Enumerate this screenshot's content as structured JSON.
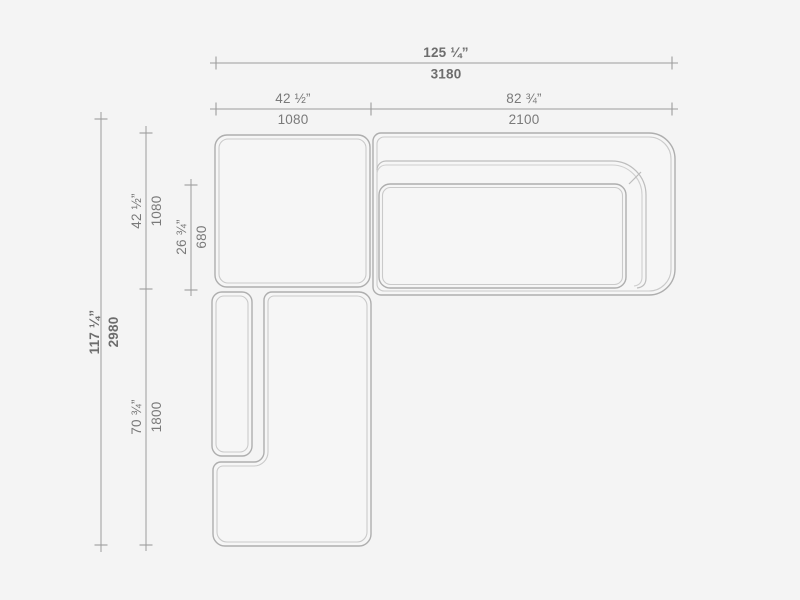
{
  "drawing": {
    "type": "sectional-sofa-top-view-dimension-drawing",
    "colors": {
      "background": "#f4f4f4",
      "dimension_line": "#9c9c9c",
      "dimension_text": "#7a7a7a",
      "dimension_text_bold": "#6d6d6d",
      "outline_outer": "#aeaeae",
      "outline_inner": "#cacaca",
      "module_fill": "#f6f6f6"
    }
  },
  "dims": {
    "overall_width": {
      "inches": "125 ¼”",
      "mm": "3180"
    },
    "corner_width": {
      "inches": "42 ½”",
      "mm": "1080"
    },
    "sofa_width": {
      "inches": "82 ¾”",
      "mm": "2100"
    },
    "overall_depth": {
      "inches": "117 ¼”",
      "mm": "2980"
    },
    "corner_depth": {
      "inches": "42 ½”",
      "mm": "1080"
    },
    "seat_depth": {
      "inches": "26 ¾”",
      "mm": "680"
    },
    "chaise_length": {
      "inches": "70 ¾”",
      "mm": "1800"
    }
  }
}
